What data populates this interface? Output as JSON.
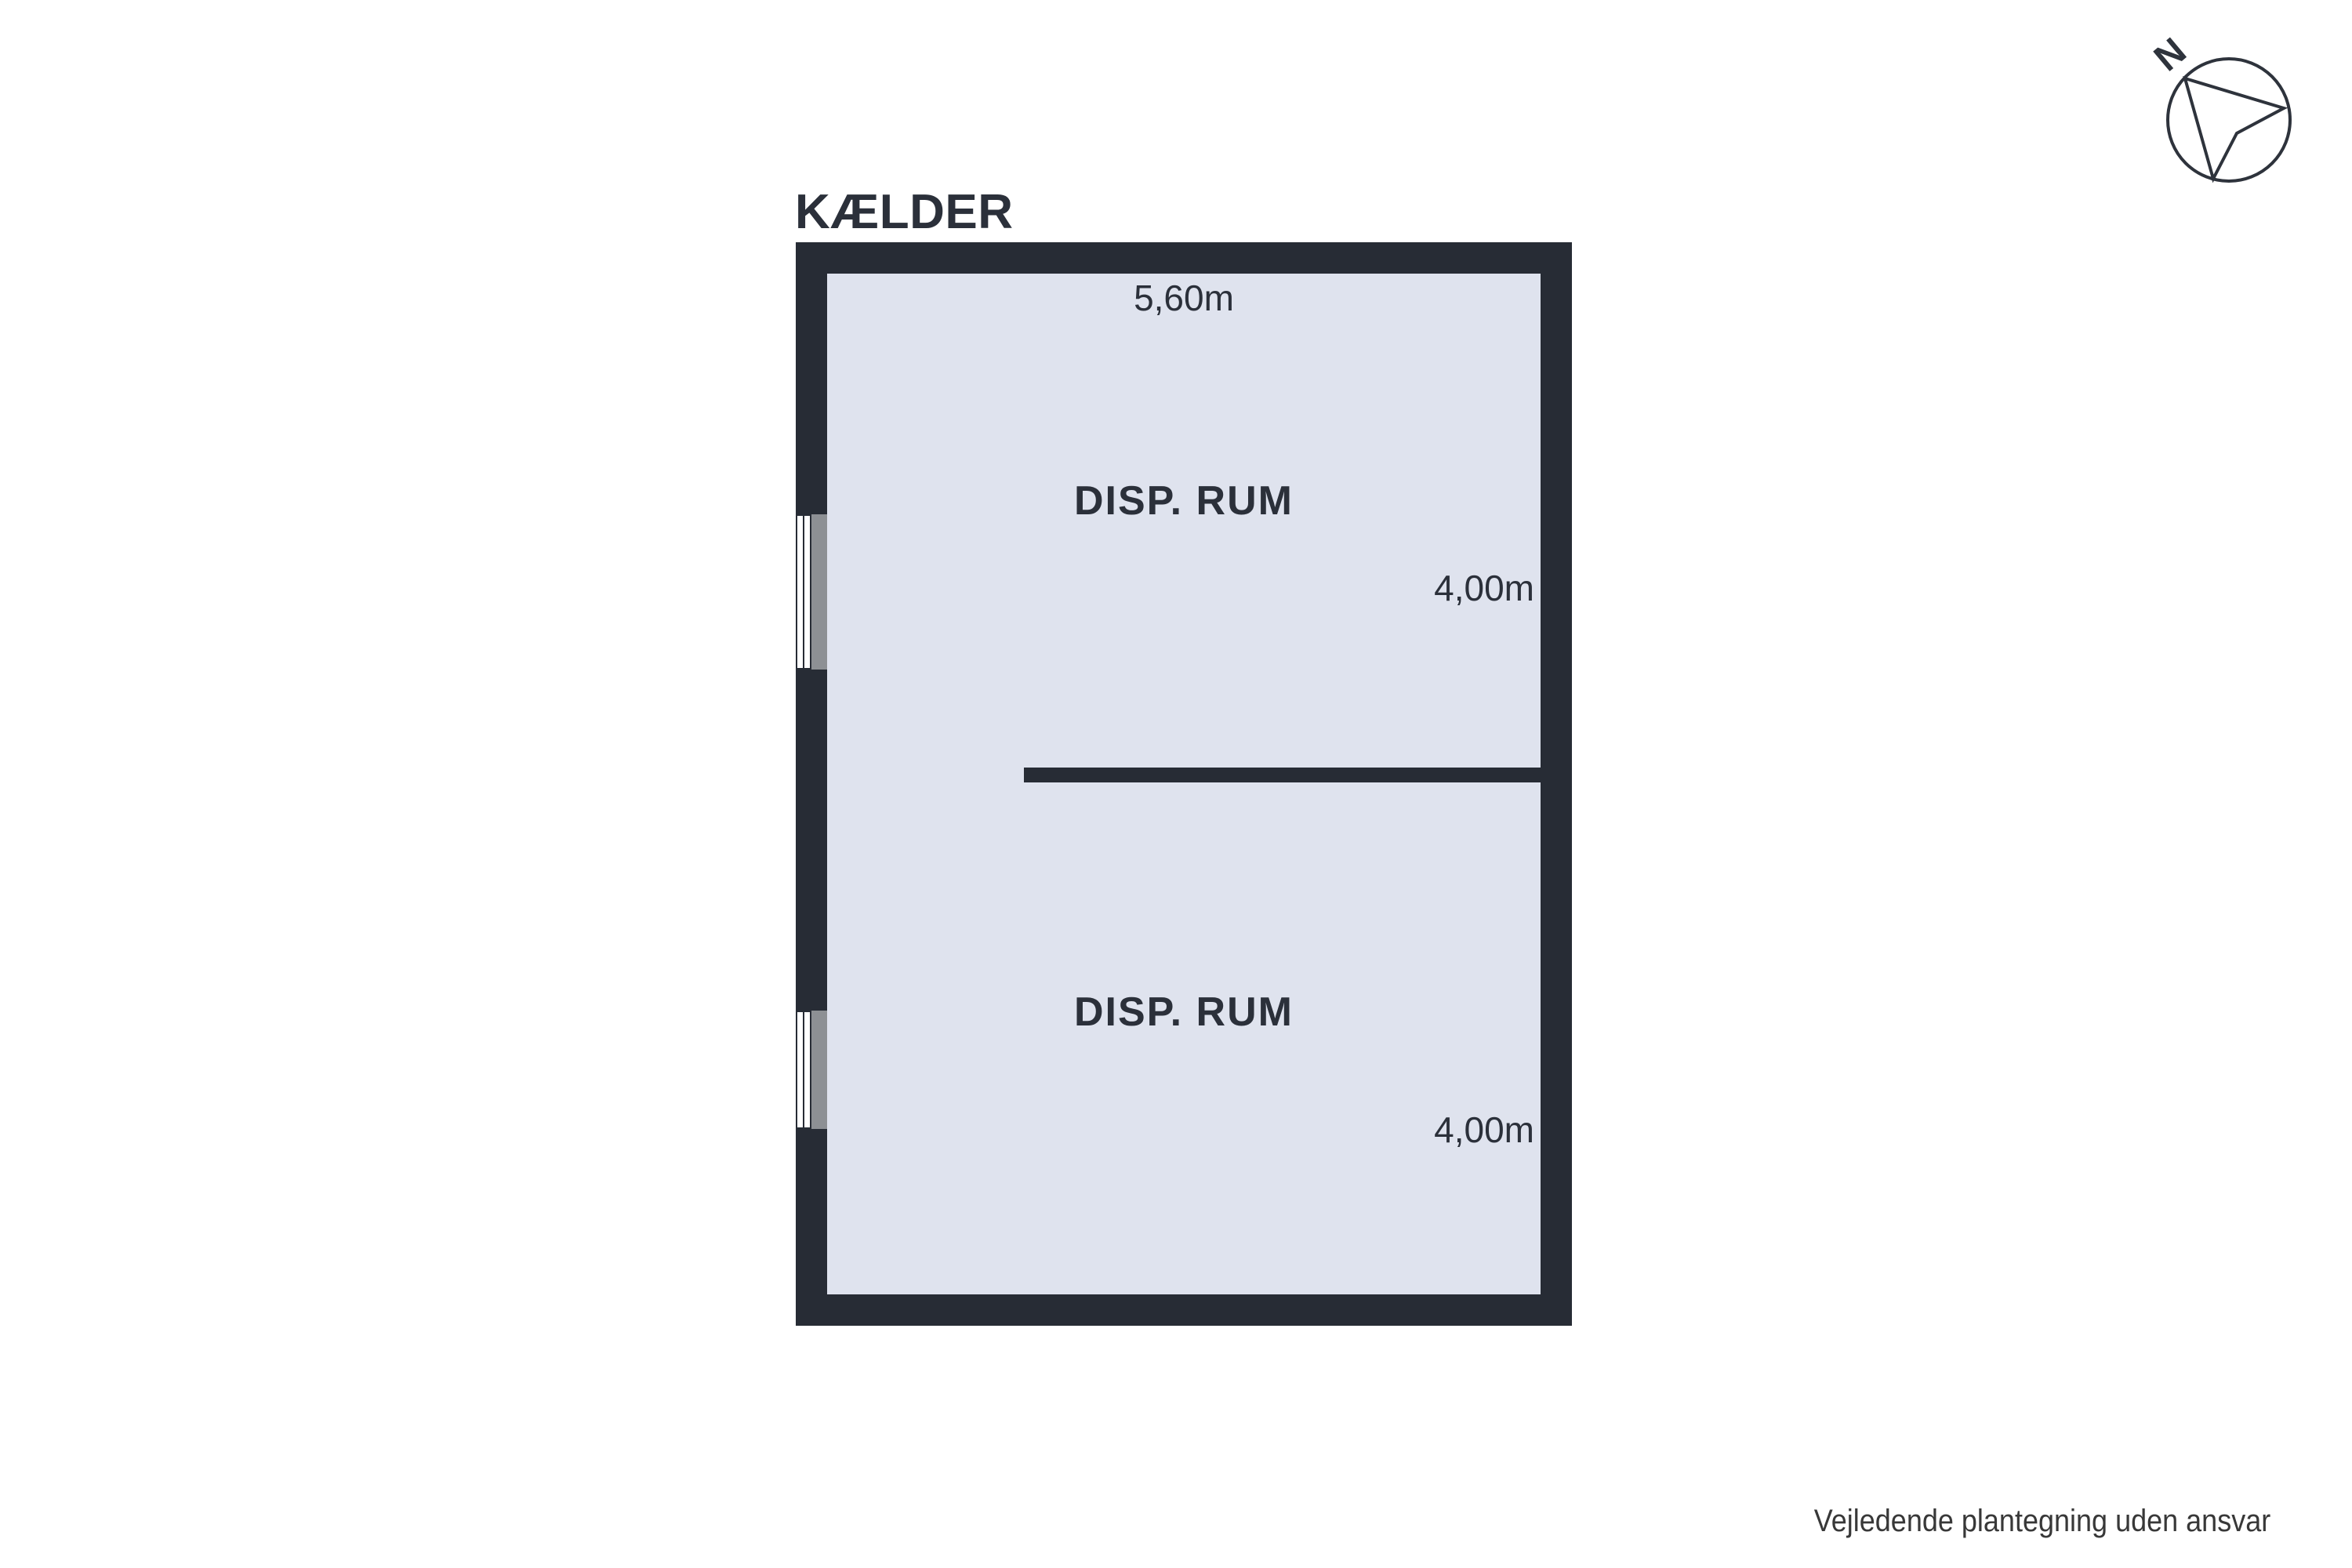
{
  "title": "KÆLDER",
  "compass": {
    "label": "N"
  },
  "floorplan": {
    "rooms": [
      {
        "name": "DISP. RUM",
        "width": "5,60m",
        "depth": "4,00m"
      },
      {
        "name": "DISP. RUM",
        "depth": "4,00m"
      }
    ]
  },
  "footer": "Vejledende plantegning uden ansvar",
  "colors": {
    "wall": "#272c35",
    "floor": "#dfe3ee",
    "sill": "#8d9094",
    "ink": "#2b303a",
    "footer": "#383838",
    "paper": "#ffffff"
  }
}
